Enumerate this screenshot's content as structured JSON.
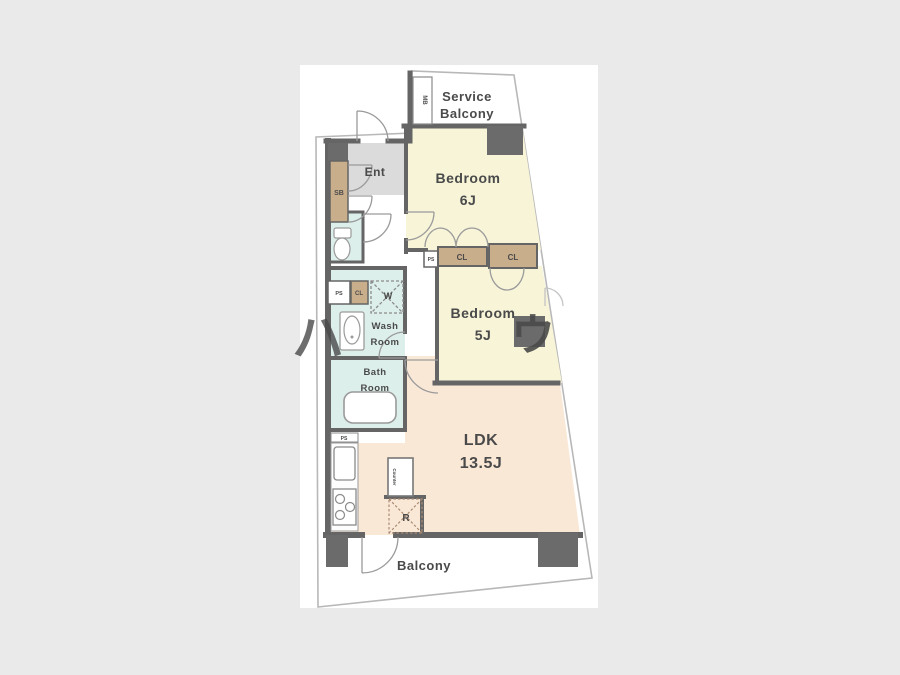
{
  "page": {
    "background": "#eaeaea",
    "card_background": "#ffffff"
  },
  "colors": {
    "wall": "#656565",
    "outline": "#b8b8b8",
    "bedroom_fill": "#f7f4d8",
    "ldk_fill": "#fae8d7",
    "closet_fill": "#c9ae8c",
    "wet_area_fill": "#ddefeb",
    "entrance_fill": "#dbdbdb",
    "label_text": "#4a4a4a",
    "refrigerator_text": "#8b4538",
    "watermark_text": "#c9c9c9"
  },
  "rooms": {
    "service_balcony": {
      "line1": "Service",
      "line2": "Balcony"
    },
    "bedroom_6": {
      "name": "Bedroom",
      "size": "6J"
    },
    "bedroom_5": {
      "name": "Bedroom",
      "size": "5J"
    },
    "ldk": {
      "name": "LDK",
      "size": "13.5J"
    },
    "entrance": {
      "label": "Ent"
    },
    "wash_room": {
      "line1": "Wash",
      "line2": "Room"
    },
    "bath_room": {
      "line1": "Bath",
      "line2": "Room"
    },
    "balcony": {
      "label": "Balcony"
    }
  },
  "fixtures": {
    "shoe_box": "SB",
    "meter_box": "MB",
    "closet_1": "CL",
    "closet_2": "CL",
    "closet_3": "CL",
    "pipe_space_1": "PS",
    "pipe_space_2": "PS",
    "pipe_space_3": "PS",
    "washer_space": "W",
    "counter": "Counter",
    "refrigerator": "R"
  },
  "watermark": {
    "char1": "ハ",
    "char2": "ウ"
  }
}
